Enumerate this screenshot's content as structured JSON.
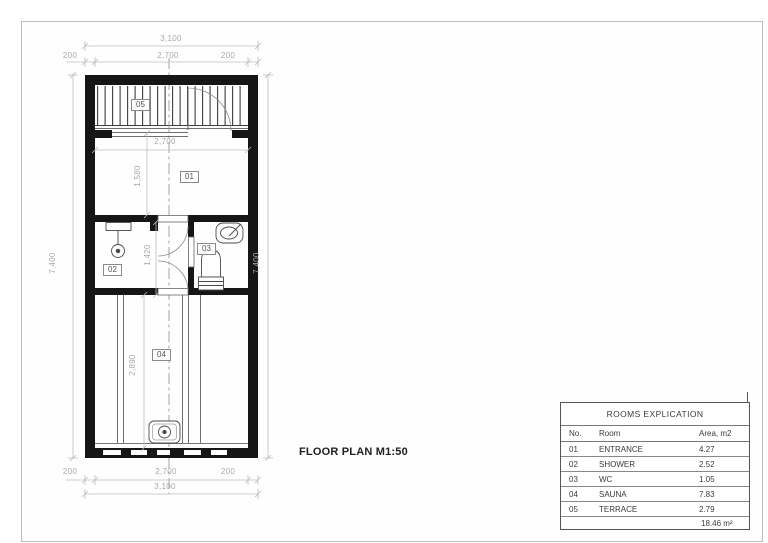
{
  "sheet": {
    "title": "FLOOR PLAN M1:50"
  },
  "plan": {
    "labels": {
      "entrance": "01",
      "shower": "02",
      "wc": "03",
      "sauna": "04",
      "terrace": "05"
    },
    "dims": {
      "top_overall": "3,100",
      "top_left": "200",
      "top_inner": "2,700",
      "top_right": "200",
      "bottom_left": "200",
      "bottom_inner": "2,700",
      "bottom_right": "200",
      "bottom_overall": "3,100",
      "left_overall": "7,400",
      "right_overall": "7,400",
      "entrance_width": "2,700",
      "entrance_depth": "1,580",
      "bath_depth": "1,420",
      "sauna_depth": "2,890"
    }
  },
  "table": {
    "title": "ROOMS EXPLICATION",
    "columns": {
      "no": "No.",
      "room": "Room",
      "area": "Area, m2"
    },
    "rows": [
      {
        "no": "01",
        "room": "ENTRANCE",
        "area": "4.27"
      },
      {
        "no": "02",
        "room": "SHOWER",
        "area": "2.52"
      },
      {
        "no": "03",
        "room": "WC",
        "area": "1.05"
      },
      {
        "no": "04",
        "room": "SAUNA",
        "area": "7.83"
      },
      {
        "no": "05",
        "room": "TERRACE",
        "area": "2.79"
      }
    ],
    "total": "18.46 m²"
  }
}
